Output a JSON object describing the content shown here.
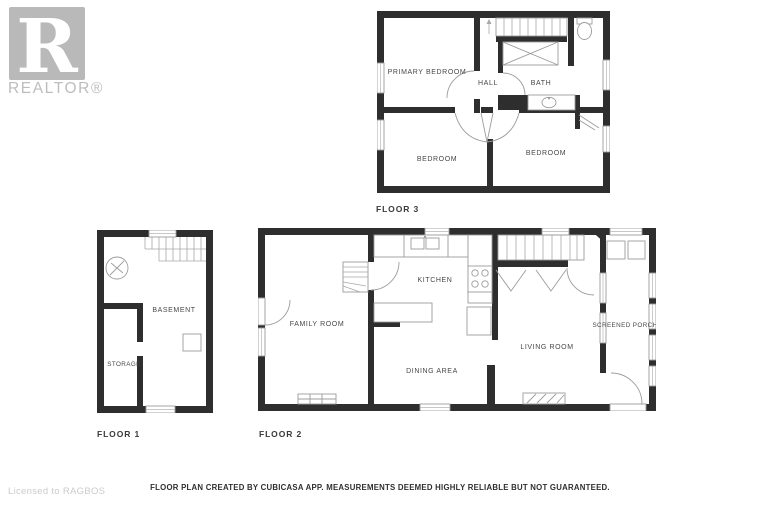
{
  "watermark": {
    "logo_letter": "R",
    "brand": "REALTOR®",
    "license": "Licensed to RAGBOS"
  },
  "footer": {
    "disclaimer": "FLOOR PLAN CREATED BY CUBICASA APP. MEASUREMENTS DEEMED HIGHLY RELIABLE BUT NOT GUARANTEED."
  },
  "floors": {
    "floor1": {
      "label": "FLOOR 1",
      "rooms": {
        "basement": "BASEMENT",
        "storage": "STORAGE"
      }
    },
    "floor2": {
      "label": "FLOOR 2",
      "rooms": {
        "family_room": "FAMILY ROOM",
        "kitchen": "KITCHEN",
        "dining_area": "DINING AREA",
        "living_room": "LIVING ROOM",
        "screened_porch": "SCREENED PORCH"
      }
    },
    "floor3": {
      "label": "FLOOR 3",
      "rooms": {
        "primary_bedroom": "PRIMARY BEDROOM",
        "hall": "HALL",
        "bath": "BATH",
        "bedroom_left": "BEDROOM",
        "bedroom_right": "BEDROOM"
      }
    }
  },
  "icons": {
    "stairs": "staircase-icon",
    "toilet": "toilet-icon",
    "bath_sink": "sink-icon",
    "closet_x": "closet-x-icon",
    "fan": "fan-icon",
    "furnace": "furnace-icon",
    "stove": "stove-icon",
    "kitchen_sink": "kitchen-sink-icon",
    "hearth": "fireplace-hearth-icon",
    "door": "door-arc-icon",
    "window": "window-icon",
    "bifold": "bifold-door-icon"
  },
  "colors": {
    "wall": "#2e2e2e",
    "fixture_line": "#9c9c9c",
    "label_text": "#474747",
    "watermark": "#b9b9b9",
    "license_text": "#cbcbcb",
    "disclaimer_text": "#2f2f2f",
    "background": "#ffffff"
  }
}
